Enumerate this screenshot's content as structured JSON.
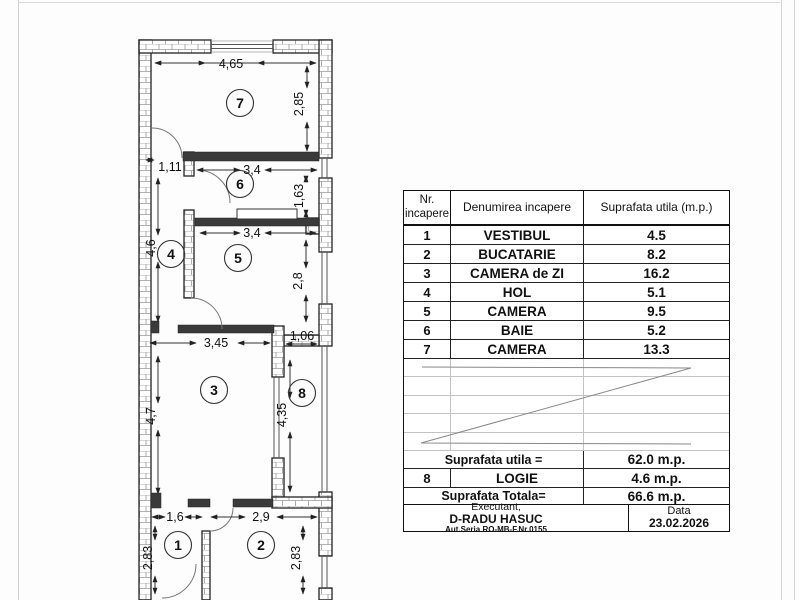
{
  "plan": {
    "rooms": [
      "1",
      "2",
      "3",
      "4",
      "5",
      "6",
      "7",
      "8"
    ],
    "dims": [
      "4,65",
      "2,85",
      "1,11",
      "3,4",
      "1,63",
      "4,6",
      "3,4",
      "2,8",
      "3,45",
      "1,06",
      "4,7",
      "4,35",
      "1,6",
      "2,9",
      "2,83",
      "2,83"
    ]
  },
  "table": {
    "header": {
      "col1_line1": "Nr.",
      "col1_line2": "incapere",
      "col2": "Denumirea incapere",
      "col3": "Suprafata utila  (m.p.)"
    },
    "rows": [
      {
        "nr": "1",
        "name": "VESTIBUL",
        "area": "4.5"
      },
      {
        "nr": "2",
        "name": "BUCATARIE",
        "area": "8.2"
      },
      {
        "nr": "3",
        "name": "CAMERA de ZI",
        "area": "16.2"
      },
      {
        "nr": "4",
        "name": "HOL",
        "area": "5.1"
      },
      {
        "nr": "5",
        "name": "CAMERA",
        "area": "9.5"
      },
      {
        "nr": "6",
        "name": "BAIE",
        "area": "5.2"
      },
      {
        "nr": "7",
        "name": "CAMERA",
        "area": "13.3"
      }
    ],
    "summary": {
      "utila_label": "Suprafata utila =",
      "utila_value": "62.0 m.p.",
      "logie_nr": "8",
      "logie_name": "LOGIE",
      "logie_value": "4.6 m.p.",
      "totala_label": "Suprafata Totala=",
      "totala_value": "66.6 m.p."
    },
    "signature": {
      "executant_label": "Executant,",
      "executant_name": "D-RADU HASUC",
      "executant_auth": "Aut.Seria RO-MB-F.Nr.0155",
      "data_label": "Data",
      "data_value": "23.02.2026"
    }
  }
}
